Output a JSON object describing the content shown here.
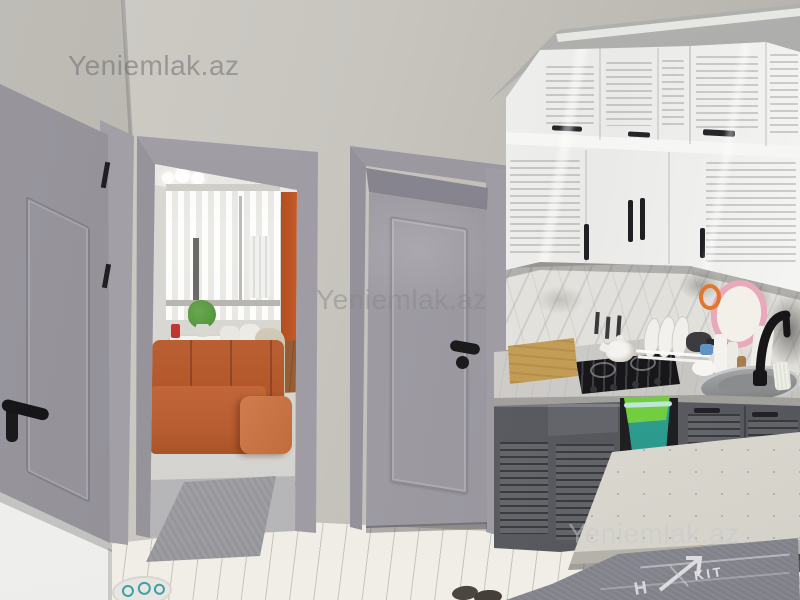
{
  "watermarks": {
    "top_left": "Yeniemlak.az",
    "center": "Yeniemlak.az",
    "bottom_right": "Yeniemlak.az"
  },
  "rug_print": {
    "fragment_kit": "KIT",
    "fragment_h": "H"
  },
  "palette": {
    "wall": "#c8c5bf",
    "ceiling": "#9b9b9d",
    "door": "#9d9aa2",
    "door_dark": "#8e8b93",
    "frame": "#a8a5ad",
    "cabinet_white": "#f3f3f1",
    "cabinet_lower": "#5a5c61",
    "counter": "#cfcecb",
    "backsplash": "#e9e7e3",
    "sofa": "#c2663a",
    "accent_wall": "#c65c28",
    "wood_floor": "#9c6137",
    "laminate": "#ebe9e2",
    "runner_rug": "#9d9da1",
    "kitchen_rug": "#8c8c94",
    "bucket": "#2fa496",
    "bag": "#72ce3e",
    "mirror": "#e8a9bb",
    "stove": "#17171a",
    "faucet": "#161618",
    "table": "#dedcd3"
  },
  "scene": {
    "setting": "apartment interior: hallway/kitchen with gray doors, open doorway to living room",
    "objects": [
      "gray entry door",
      "doorway to living room",
      "globe ceiling light",
      "sheer curtained window",
      "orange accent wall",
      "dining table with white chairs",
      "beige chair",
      "orange sectional sofa",
      "wood floor",
      "light area rug",
      "gray runner rug",
      "gray paneled interior door",
      "white louvered upper cabinets",
      "marble backsplash",
      "pink hand mirror",
      "wooden box",
      "gas cooktop",
      "white teapot",
      "dish rack with plates",
      "bottles",
      "stainless sink",
      "black gooseneck faucet",
      "gray louvered lower cabinets",
      "green bucket with bag",
      "white speckled table",
      "kitchen print rug",
      "laminate floor",
      "white counter corner",
      "oval mat",
      "dark slippers"
    ]
  }
}
